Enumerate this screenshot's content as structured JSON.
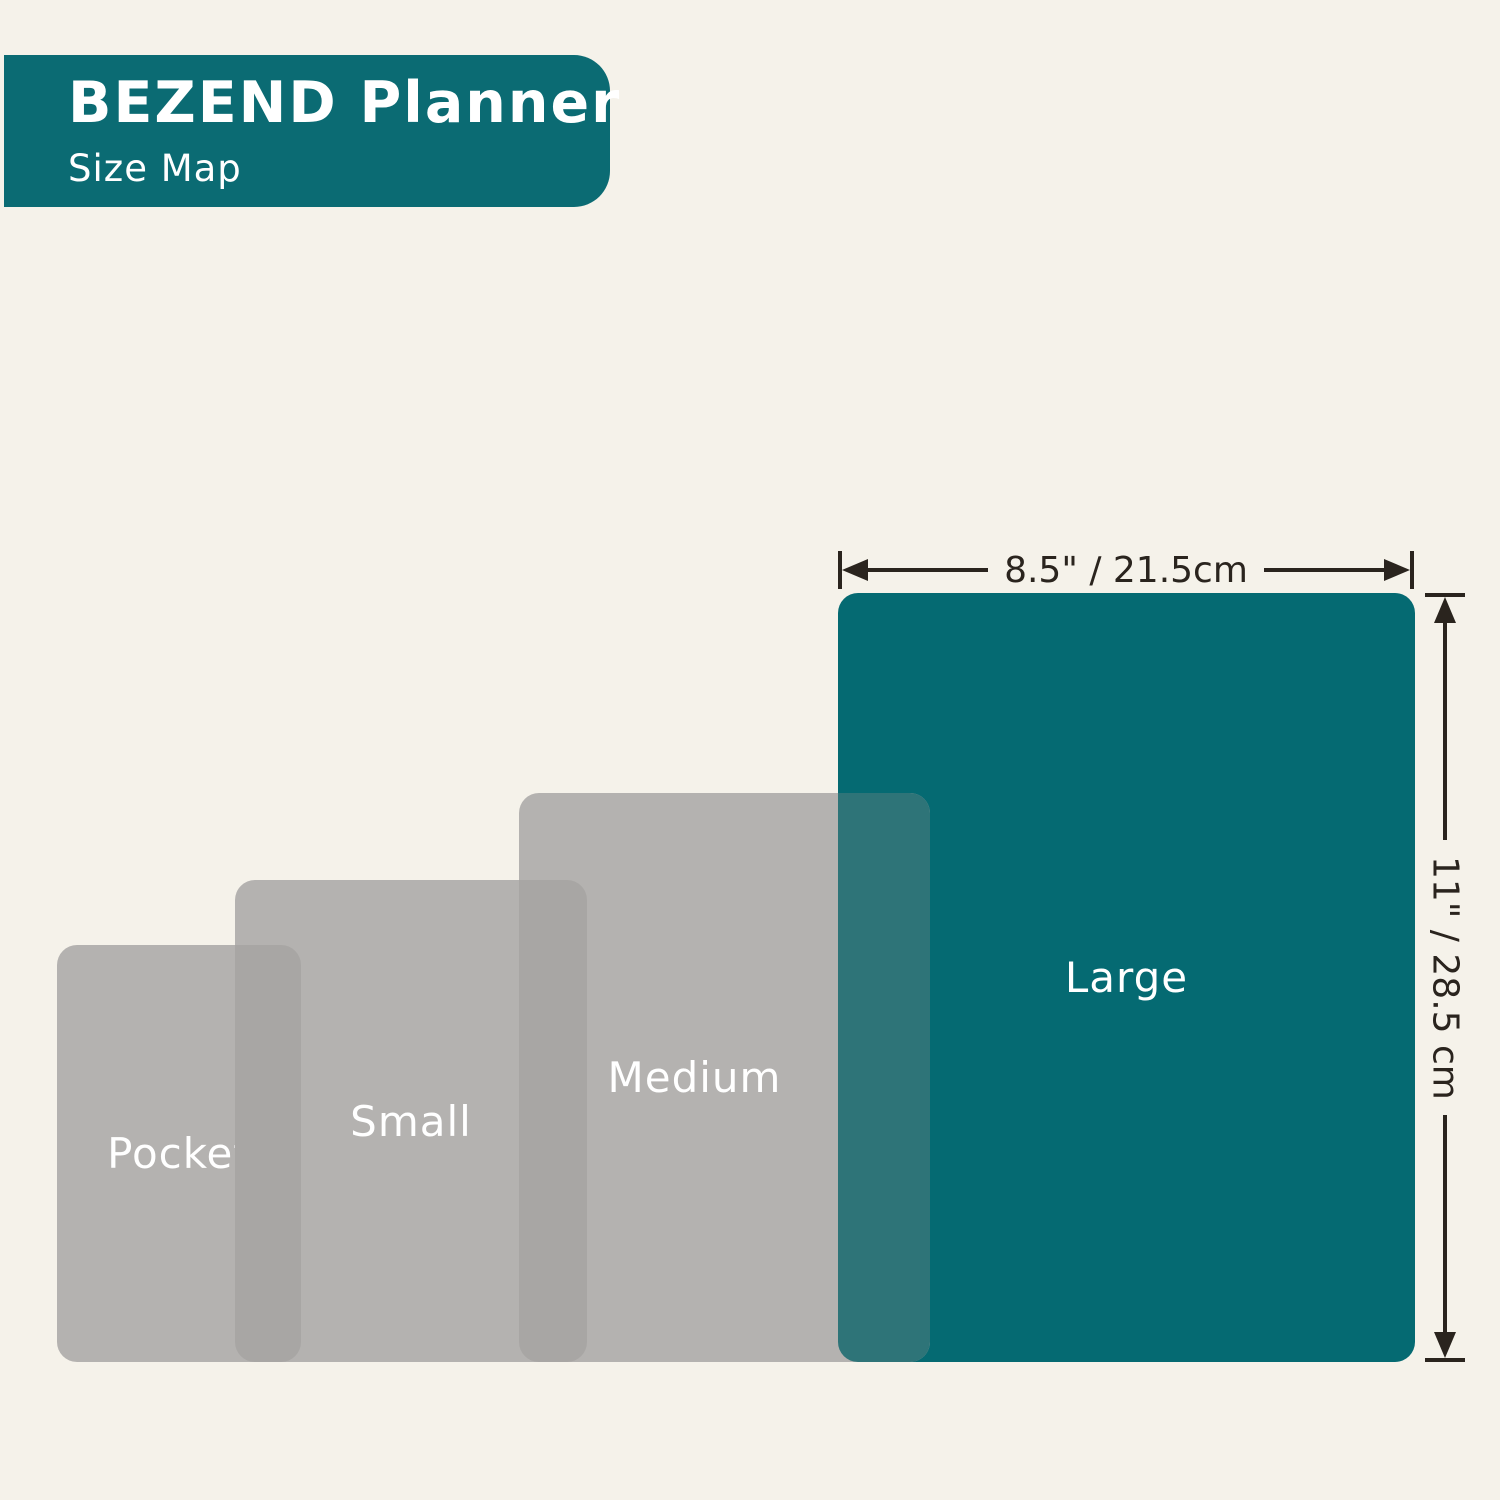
{
  "header": {
    "title": "BEZEND Planner",
    "subtitle": "Size Map"
  },
  "sizes": [
    {
      "id": "pocket",
      "label": "Pocket"
    },
    {
      "id": "small",
      "label": "Small"
    },
    {
      "id": "medium",
      "label": "Medium"
    },
    {
      "id": "large",
      "label": "Large"
    }
  ],
  "dimensions": {
    "width_label": "8.5\" / 21.5cm",
    "height_label": "11\" / 28.5 cm"
  },
  "colors": {
    "background": "#F5F2EA",
    "badge_teal": "#0B6B73",
    "large_teal": "#056A72",
    "teal_overlap": "#2E7478",
    "gray": "#B4B2B0",
    "gray_overlap": "#A8A6A4",
    "ink": "#2A241E",
    "label_text": "#FFFFFF"
  }
}
